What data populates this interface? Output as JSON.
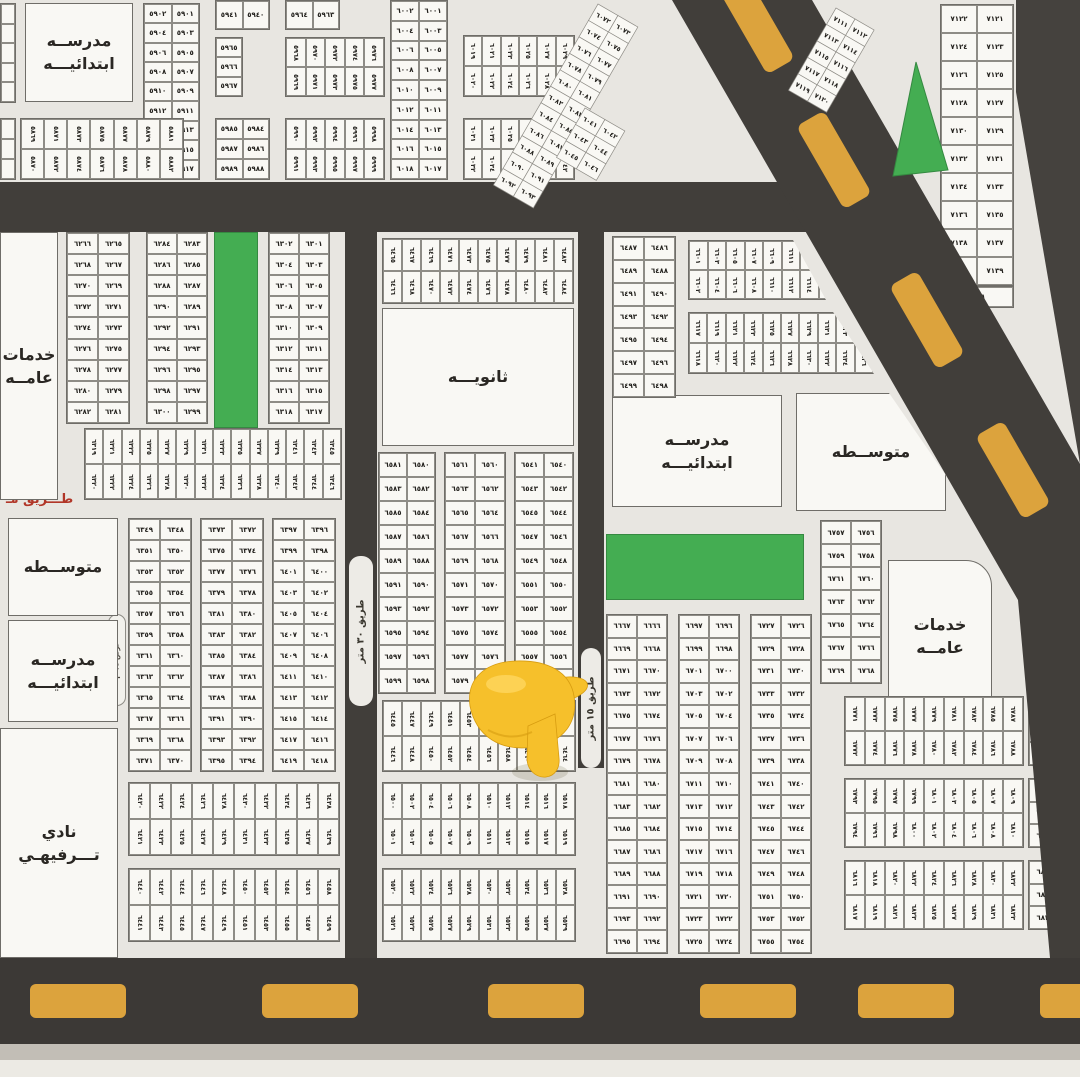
{
  "colors": {
    "land": "#e8e6e1",
    "block": "#f9f8f4",
    "road": "#413e3a",
    "dash": "#dca33d",
    "green": "#44ad52",
    "number": "#23211d",
    "label": "#2a2723",
    "red_label": "#b13628",
    "border": "#6f6d68",
    "cell_border": "#8e8c86",
    "hand": "#f6c02b",
    "hand_dark": "#d79c10",
    "hand_light": "#ffd65f"
  },
  "roads": {
    "v30": {
      "label": "طريق ٣٠ متر"
    },
    "v15": {
      "label": "طريق ١٥ متر"
    },
    "red_street_label": {
      "text": "طـــريق مـ"
    },
    "lane_label": {
      "text": "عرض ١٥ م"
    }
  },
  "facilities": [
    {
      "id": "school-elementary-nw",
      "x": 25,
      "y": 3,
      "w": 108,
      "h": 99,
      "lines": [
        "مدرســه",
        "ابتدائيـــه"
      ]
    },
    {
      "id": "public-services-west",
      "x": 0,
      "y": 232,
      "w": 58,
      "h": 268,
      "lines": [
        "خدمات",
        "عامــه"
      ]
    },
    {
      "id": "secondary-school",
      "x": 382,
      "y": 308,
      "w": 192,
      "h": 138,
      "lines": [
        "ثانويـــه"
      ]
    },
    {
      "id": "school-elementary-center",
      "x": 612,
      "y": 395,
      "w": 170,
      "h": 112,
      "lines": [
        "مدرســه",
        "ابتدائيـــه"
      ]
    },
    {
      "id": "middle-school-east",
      "x": 796,
      "y": 393,
      "w": 150,
      "h": 118,
      "lines": [
        "متوســطه"
      ],
      "clip": "polygon(0 0,62% 0,100% 70%,100% 100%,0 100%)"
    },
    {
      "id": "public-services-east",
      "x": 888,
      "y": 560,
      "w": 104,
      "h": 152,
      "lines": [
        "خدمات",
        "عامــه"
      ],
      "round_tr": 26
    },
    {
      "id": "middle-school-west",
      "x": 8,
      "y": 518,
      "w": 110,
      "h": 98,
      "lines": [
        "متوســطه"
      ]
    },
    {
      "id": "school-elementary-west",
      "x": 8,
      "y": 620,
      "w": 110,
      "h": 102,
      "lines": [
        "مدرســه",
        "ابتدائيـــه"
      ]
    },
    {
      "id": "recreation-club",
      "x": 0,
      "y": 728,
      "w": 118,
      "h": 230,
      "lines": [
        "نادي",
        "تـــرفيهـي"
      ]
    }
  ],
  "greens": [
    {
      "x": 214,
      "y": 232,
      "w": 44,
      "h": 196
    },
    {
      "x": 606,
      "y": 534,
      "w": 198,
      "h": 66
    }
  ],
  "pair_blocks": [
    {
      "x": 143,
      "y": 3,
      "w": 57,
      "h": 177,
      "start": 5901,
      "rows": 9,
      "cols": 2
    },
    {
      "x": 215,
      "y": 0,
      "w": 55,
      "h": 30,
      "start": 5940,
      "rows": 1,
      "cols": 2
    },
    {
      "x": 215,
      "y": 37,
      "w": 28,
      "h": 60,
      "start": 5965,
      "rows": 3,
      "cols": 1
    },
    {
      "x": 215,
      "y": 118,
      "w": 55,
      "h": 62,
      "start": 5984,
      "rows": 3,
      "cols": 2
    },
    {
      "x": 285,
      "y": 0,
      "w": 55,
      "h": 30,
      "start": 5963,
      "rows": 1,
      "cols": 2
    },
    {
      "x": 390,
      "y": 0,
      "w": 58,
      "h": 180,
      "start": 6001,
      "rows": 9,
      "cols": 2
    },
    {
      "x": 66,
      "y": 232,
      "w": 64,
      "h": 192,
      "start": 6265,
      "rows": 9,
      "cols": 2
    },
    {
      "x": 146,
      "y": 232,
      "w": 62,
      "h": 192,
      "start": 6283,
      "rows": 9,
      "cols": 2
    },
    {
      "x": 268,
      "y": 232,
      "w": 62,
      "h": 192,
      "start": 6301,
      "rows": 9,
      "cols": 2
    },
    {
      "x": 128,
      "y": 518,
      "w": 64,
      "h": 254,
      "start": 6348,
      "rows": 12,
      "cols": 2
    },
    {
      "x": 200,
      "y": 518,
      "w": 64,
      "h": 254,
      "start": 6372,
      "rows": 12,
      "cols": 2
    },
    {
      "x": 272,
      "y": 518,
      "w": 64,
      "h": 254,
      "start": 6396,
      "rows": 12,
      "cols": 2
    },
    {
      "x": 378,
      "y": 452,
      "w": 58,
      "h": 242,
      "start": 6580,
      "rows": 10,
      "cols": 2
    },
    {
      "x": 444,
      "y": 452,
      "w": 62,
      "h": 242,
      "start": 6560,
      "rows": 10,
      "cols": 2
    },
    {
      "x": 514,
      "y": 452,
      "w": 60,
      "h": 242,
      "start": 6540,
      "rows": 10,
      "cols": 2
    },
    {
      "x": 612,
      "y": 236,
      "w": 64,
      "h": 162,
      "start": 6486,
      "rows": 7,
      "cols": 2
    },
    {
      "x": 820,
      "y": 520,
      "w": 62,
      "h": 164,
      "start": 6756,
      "rows": 7,
      "cols": 2
    },
    {
      "x": 606,
      "y": 614,
      "w": 62,
      "h": 340,
      "start": 6666,
      "rows": 15,
      "cols": 2
    },
    {
      "x": 678,
      "y": 614,
      "w": 62,
      "h": 340,
      "start": 6696,
      "rows": 15,
      "cols": 2
    },
    {
      "x": 750,
      "y": 614,
      "w": 62,
      "h": 340,
      "start": 6726,
      "rows": 15,
      "cols": 2
    },
    {
      "x": 940,
      "y": 4,
      "w": 74,
      "h": 282,
      "start": 7121,
      "rows": 10,
      "cols": 2
    },
    {
      "x": 940,
      "y": 286,
      "w": 74,
      "h": 22,
      "start": 7141,
      "rows": 1,
      "cols": 1
    }
  ],
  "strips": [
    {
      "x": 20,
      "y": 118,
      "w": 164,
      "h": 62,
      "start": 5869,
      "cols": 7
    },
    {
      "x": 285,
      "y": 37,
      "w": 100,
      "h": 60,
      "start": 5968,
      "cols": 5
    },
    {
      "x": 285,
      "y": 118,
      "w": 100,
      "h": 62,
      "start": 5990,
      "cols": 5
    },
    {
      "x": 463,
      "y": 35,
      "w": 112,
      "h": 62,
      "start": 6019,
      "cols": 6
    },
    {
      "x": 463,
      "y": 118,
      "w": 112,
      "h": 62,
      "start": 6031,
      "cols": 6
    },
    {
      "x": 84,
      "y": 428,
      "w": 258,
      "h": 72,
      "start": 6319,
      "cols": 14
    },
    {
      "x": 382,
      "y": 238,
      "w": 192,
      "h": 66,
      "start": 6465,
      "cols": 10
    },
    {
      "x": 382,
      "y": 700,
      "w": 194,
      "h": 72,
      "start": 6445,
      "cols": 10
    },
    {
      "x": 382,
      "y": 782,
      "w": 194,
      "h": 74,
      "start": 6500,
      "cols": 10
    },
    {
      "x": 382,
      "y": 868,
      "w": 194,
      "h": 74,
      "start": 6520,
      "cols": 10
    },
    {
      "x": 128,
      "y": 782,
      "w": 212,
      "h": 74,
      "start": 6420,
      "cols": 10
    },
    {
      "x": 128,
      "y": 868,
      "w": 212,
      "h": 74,
      "start": 6440,
      "cols": 10
    },
    {
      "x": 844,
      "y": 696,
      "w": 180,
      "h": 70,
      "start": 6771,
      "cols": 9
    },
    {
      "x": 844,
      "y": 778,
      "w": 180,
      "h": 70,
      "start": 6793,
      "cols": 9
    },
    {
      "x": 844,
      "y": 860,
      "w": 180,
      "h": 70,
      "start": 6816,
      "cols": 9
    }
  ],
  "clipped_strips": [
    {
      "x": 688,
      "y": 240,
      "w": 150,
      "h": 60,
      "start": 6601,
      "cols": 8,
      "clip": "polygon(0 0,70% 0,92% 100%,0 100%)"
    },
    {
      "x": 688,
      "y": 312,
      "w": 186,
      "h": 62,
      "start": 6617,
      "cols": 10,
      "clip": "polygon(0 0,78% 0,100% 100%,0 100%)"
    }
  ],
  "single_cols": [
    {
      "x": 1028,
      "y": 696,
      "w": 34,
      "h": 70,
      "start": 6790,
      "rows": 3
    },
    {
      "x": 1028,
      "y": 778,
      "w": 34,
      "h": 70,
      "start": 6813,
      "rows": 3
    },
    {
      "x": 1028,
      "y": 860,
      "w": 34,
      "h": 70,
      "start": 6836,
      "rows": 3
    }
  ],
  "blanks": [
    {
      "x": 0,
      "y": 3,
      "w": 16,
      "h": 100,
      "rows": 5
    },
    {
      "x": 0,
      "y": 118,
      "w": 16,
      "h": 62,
      "rows": 3
    }
  ],
  "diagonal": {
    "roadA_points": "672,0 812,0 1080,464 1080,958 1050,958 1018,600",
    "roadB_points": "1016,0 1080,0 1080,464 1016,92",
    "dashesA": [
      [
        757,
        25
      ],
      [
        834,
        160
      ],
      [
        927,
        320
      ],
      [
        1013,
        470
      ]
    ],
    "dash_angle": 60,
    "green_triangle": "916,62 893,176 948,170",
    "rot_groups": [
      {
        "x": 598,
        "y": 4,
        "angle": 30,
        "start": 6072,
        "rows": 11,
        "cols": 2,
        "cw": 23,
        "ch": 19
      },
      {
        "x": 585,
        "y": 108,
        "angle": 30,
        "start": 6041,
        "rows": 3,
        "cols": 2,
        "cw": 23,
        "ch": 19
      },
      {
        "x": 836,
        "y": 8,
        "angle": 30,
        "start": 7111,
        "rows": 5,
        "cols": 2,
        "cw": 22,
        "ch": 19
      }
    ]
  },
  "bottom_dashes": {
    "xs": [
      30,
      262,
      488,
      700,
      858,
      1040
    ],
    "y": 984,
    "w": 96,
    "h": 34
  }
}
